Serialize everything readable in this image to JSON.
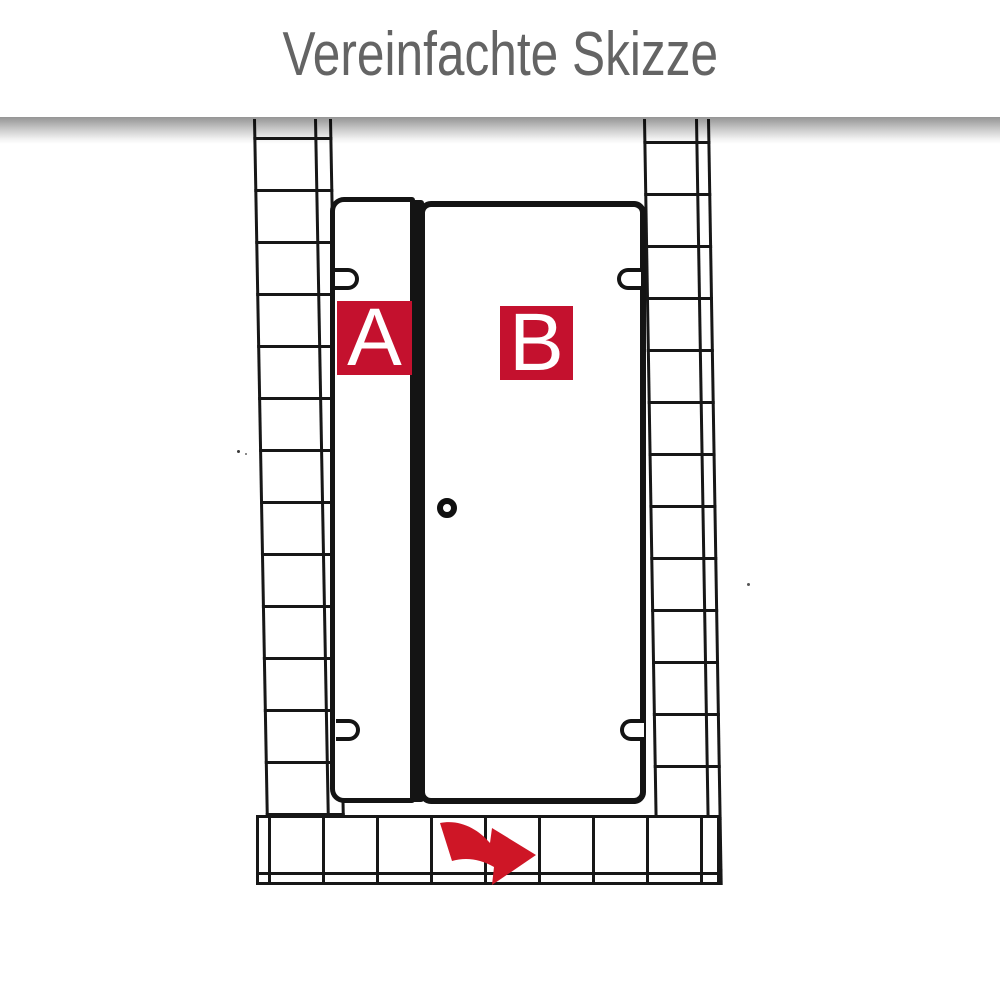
{
  "title": {
    "text": "Vereinfachte Skizze"
  },
  "labels": {
    "panel_a": "A",
    "panel_b": "B"
  },
  "icons": {
    "swing_arrow_icon": "curved-arrow-right (door opening direction)"
  },
  "colors": {
    "label_red": "#C4112E",
    "arrow_red": "#CE1626",
    "sketch_ink": "#171717",
    "title_gray": "#646464"
  }
}
